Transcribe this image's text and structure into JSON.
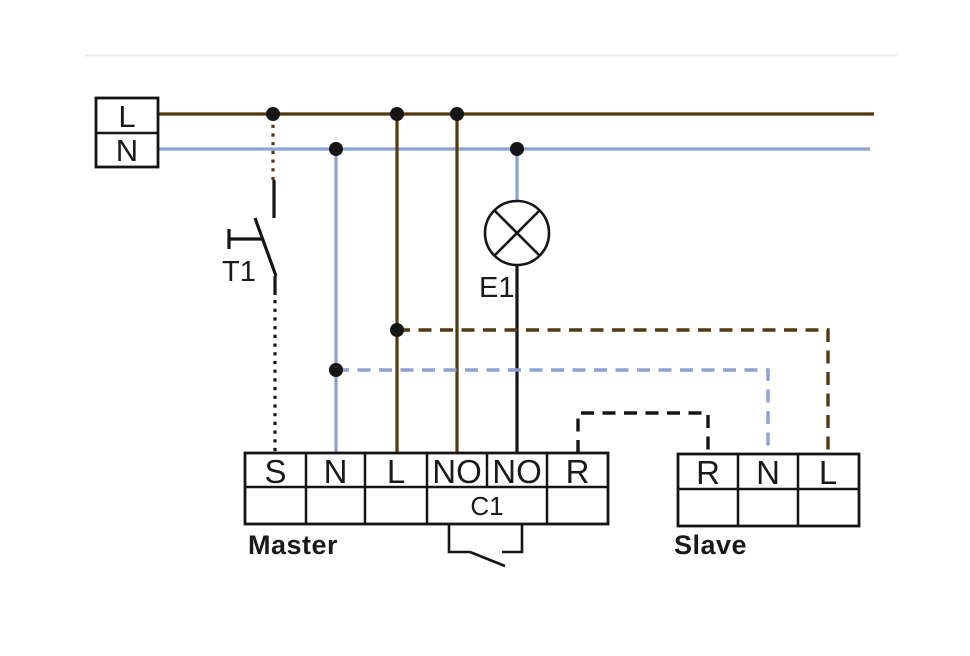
{
  "colors": {
    "brown": "#54380e",
    "blue": "#8ba2d2",
    "black": "#151515",
    "rule_gray": "#e9e9e9"
  },
  "supply": {
    "live_label": "L",
    "neutral_label": "N"
  },
  "switch": {
    "label": "T1"
  },
  "lamp": {
    "label": "E1"
  },
  "relay": {
    "label": "C1"
  },
  "master": {
    "caption": "Master",
    "terminals": [
      "S",
      "N",
      "L",
      "NO",
      "NO",
      "R"
    ]
  },
  "slave": {
    "caption": "Slave",
    "terminals": [
      "R",
      "N",
      "L"
    ]
  }
}
